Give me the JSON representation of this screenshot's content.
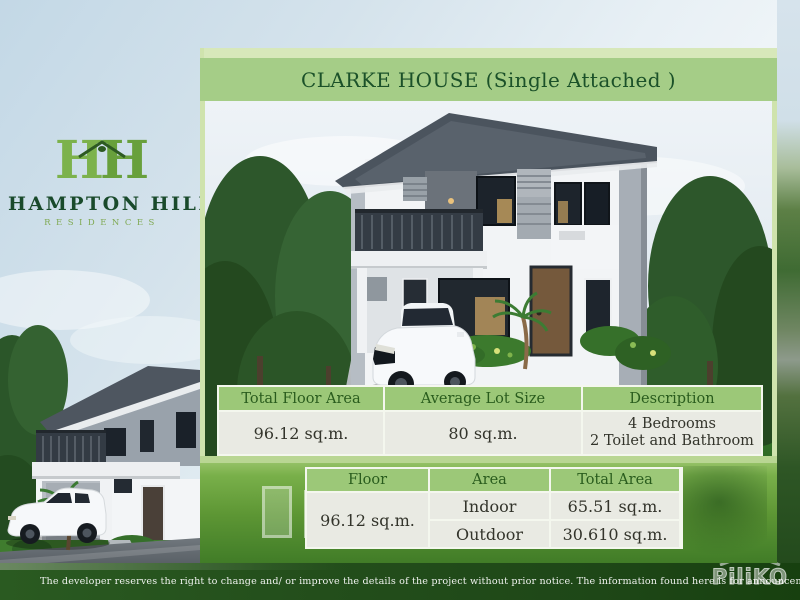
{
  "brand": {
    "monogram_left": "H",
    "monogram_right": "H",
    "name": "HAMPTON HILL",
    "subtitle": "RESIDENCES"
  },
  "panel": {
    "title": "CLARKE HOUSE (Single Attached )"
  },
  "spec_table": {
    "headers": [
      "Total Floor Area",
      "Average Lot Size",
      "Description"
    ],
    "total_floor_area": "96.12 sq.m.",
    "average_lot_size": "80 sq.m.",
    "description_line1": "4 Bedrooms",
    "description_line2": "2 Toilet and Bathroom"
  },
  "floor_table": {
    "headers": [
      "Floor",
      "Area",
      "Total Area"
    ],
    "rows": [
      {
        "floor": "Indoor",
        "area": "65.51 sq.m."
      },
      {
        "floor": "Outdoor",
        "area": "30.610 sq.m."
      }
    ],
    "total_area": "96.12 sq.m."
  },
  "footer": {
    "disclaimer": "The developer reserves the right to change and/ or improve the details of the project without prior notice. The information found here is for announcement and reference only.",
    "watermark": "PiliKO"
  },
  "colors": {
    "title_bar_green": "#a5cd87",
    "title_strip_green": "#d7e8ba",
    "table_header_green": "#9cc878",
    "table_body_gray": "#e9eae3",
    "dark_green_text": "#1b5129",
    "footer_band_green": "#24511c",
    "brand_green": "#78af47",
    "panel_border_green": "#cfe3ad"
  }
}
